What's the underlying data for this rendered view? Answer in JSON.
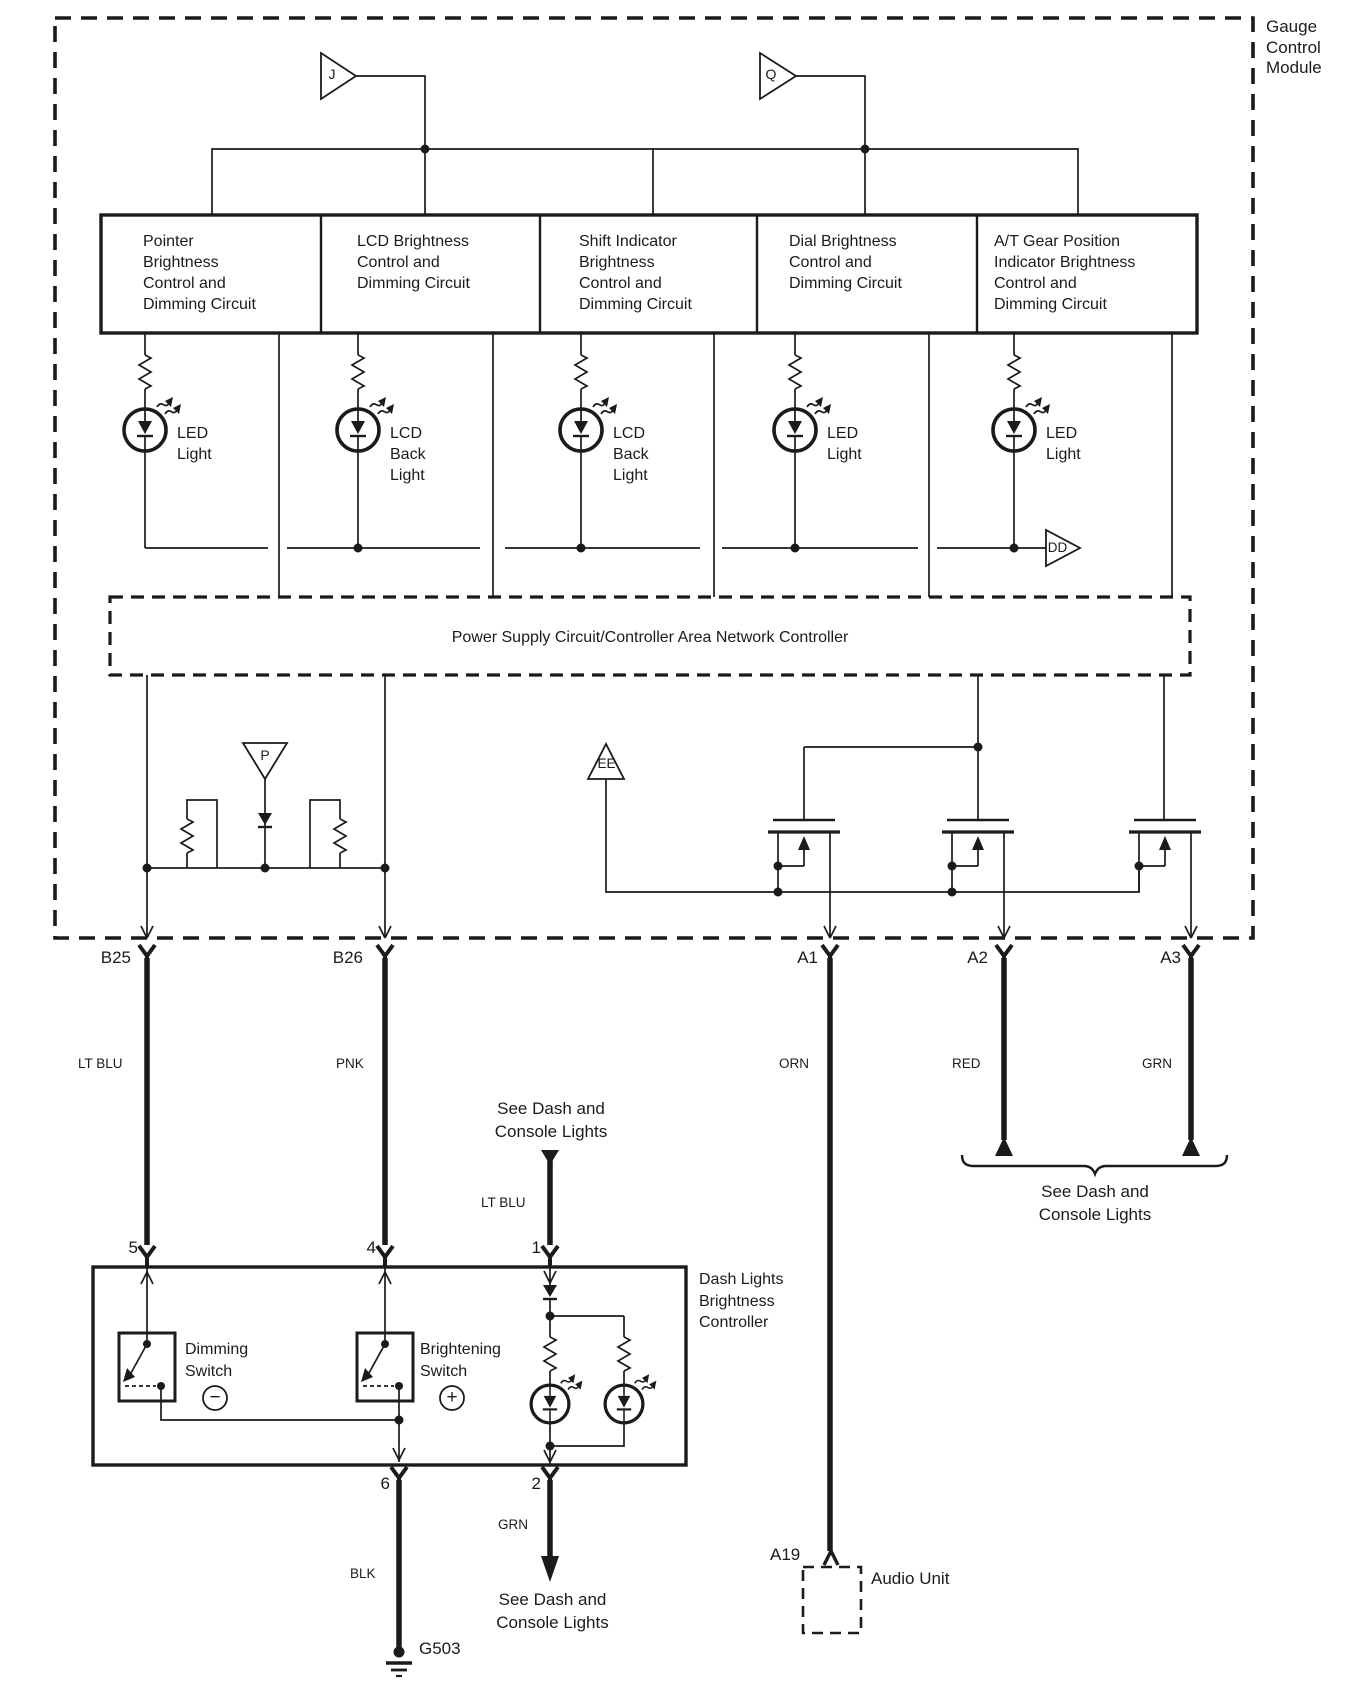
{
  "module": {
    "title": "Gauge\nControl\nModule"
  },
  "refs": {
    "j": "J",
    "q": "Q",
    "p": "P",
    "ee": "EE",
    "dd": "DD"
  },
  "circuit_boxes": [
    {
      "label": "Pointer\nBrightness\nControl and\nDimming Circuit"
    },
    {
      "label": "LCD Brightness\nControl and\nDimming Circuit"
    },
    {
      "label": "Shift Indicator\nBrightness\nControl and\nDimming Circuit"
    },
    {
      "label": "Dial Brightness\nControl and\nDimming Circuit"
    },
    {
      "label": "A/T Gear Position\nIndicator Brightness\nControl and\nDimming Circuit"
    }
  ],
  "lamps": [
    {
      "label": "LED\nLight"
    },
    {
      "label": "LCD\nBack\nLight"
    },
    {
      "label": "LCD\nBack\nLight"
    },
    {
      "label": "LED\nLight"
    },
    {
      "label": "LED\nLight"
    }
  ],
  "power_controller": {
    "label": "Power Supply Circuit/Controller Area Network Controller"
  },
  "pins_top": [
    {
      "id": "B25",
      "wire_color": "LT BLU"
    },
    {
      "id": "B26",
      "wire_color": "PNK"
    },
    {
      "id": "A1",
      "wire_color": "ORN"
    },
    {
      "id": "A2",
      "wire_color": "RED"
    },
    {
      "id": "A3",
      "wire_color": "GRN"
    }
  ],
  "notes": {
    "see_dash_top": "See Dash and\nConsole Lights",
    "lt_blu_in": "LT BLU",
    "bracket_note": "See Dash and\nConsole Lights",
    "grn_out": "GRN",
    "blk": "BLK",
    "see_dash_bottom": "See Dash and\nConsole Lights"
  },
  "controller": {
    "title": "Dash Lights\nBrightness\nController",
    "dimming_switch": "Dimming\nSwitch",
    "brightening_switch": "Brightening\nSwitch",
    "minus_sign": "−",
    "plus_sign": "+",
    "pin5": "5",
    "pin4": "4",
    "pin1": "1",
    "pin6": "6",
    "pin2": "2"
  },
  "ground": {
    "id": "G503"
  },
  "audio": {
    "pin": "A19",
    "label": "Audio Unit"
  }
}
